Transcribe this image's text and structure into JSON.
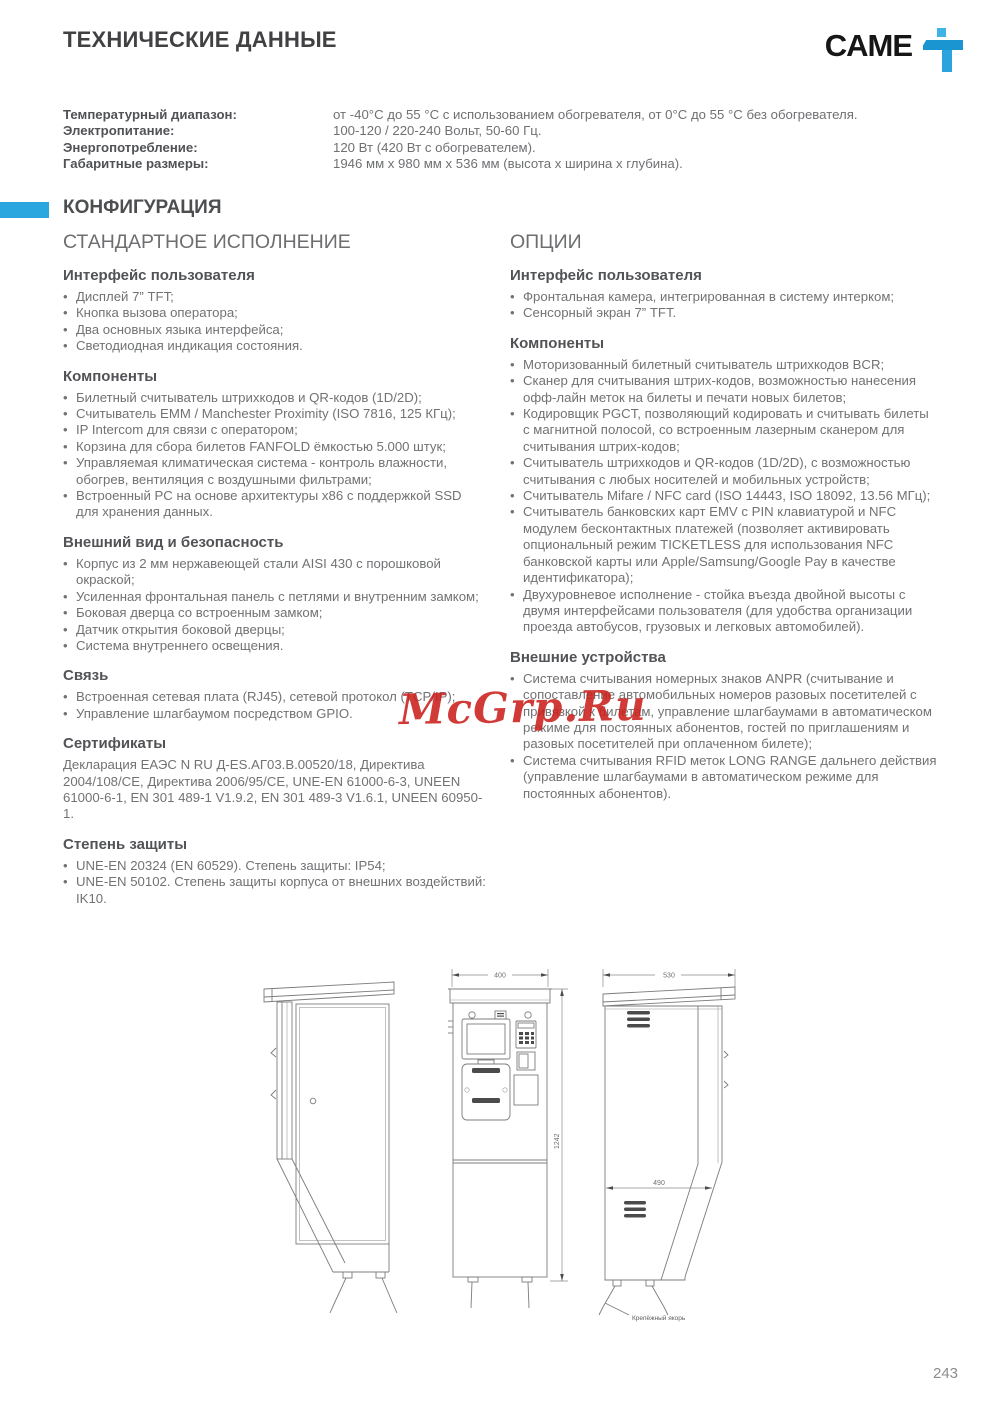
{
  "header": {
    "title": "ТЕХНИЧЕСКИЕ ДАННЫЕ",
    "brand": "CAME",
    "brand_mark_icon": "came-figure-icon"
  },
  "specs": [
    {
      "label": "Температурный диапазон:",
      "value": "от -40°C до 55 °C с использованием обогревателя, от 0°C до 55 °C без обогревателя."
    },
    {
      "label": "Электропитание:",
      "value": "100-120 / 220-240 Вольт, 50-60 Гц."
    },
    {
      "label": "Энергопотребление:",
      "value": "120 Вт (420 Вт с обогревателем)."
    },
    {
      "label": "Габаритные размеры:",
      "value": "1946 мм x 980 мм x 536 мм (высота x ширина x глубина)."
    }
  ],
  "config": {
    "section_title": "КОНФИГУРАЦИЯ",
    "left": {
      "title": "СТАНДАРТНОЕ ИСПОЛНЕНИЕ",
      "groups": [
        {
          "heading": "Интерфейс пользователя",
          "items": [
            "Дисплей 7” TFT;",
            "Кнопка вызова оператора;",
            "Два основных языка интерфейса;",
            "Светодиодная индикация состояния."
          ]
        },
        {
          "heading": "Компоненты",
          "items": [
            "Билетный считыватель штрихкодов и QR-кодов (1D/2D);",
            "Считыватель EMM / Manchester Proximity (ISO 7816, 125 КГц);",
            "IP Intercom для связи с оператором;",
            "Корзина для сбора билетов FANFOLD ёмкостью 5.000 штук;",
            "Управляемая климатическая система - контроль влажности, обогрев, вентиляция с воздушными фильтрами;",
            "Встроенный PC на основе архитектуры x86 с поддержкой SSD для хранения данных."
          ]
        },
        {
          "heading": "Внешний вид и безопасность",
          "items": [
            "Корпус из 2 мм нержавеющей стали AISI 430 с порошковой окраской;",
            "Усиленная фронтальная панель с петлями и внутренним замком;",
            "Боковая дверца со встроенным замком;",
            "Датчик открытия боковой дверцы;",
            "Система внутреннего освещения."
          ]
        },
        {
          "heading": "Связь",
          "items": [
            "Встроенная сетевая плата (RJ45), сетевой протокол (TCP/IP);",
            "Управление шлагбаумом посредством GPIO."
          ]
        },
        {
          "heading": "Сертификаты",
          "text": "Декларация ЕАЭС N RU Д-ES.АГ03.В.00520/18, Директива 2004/108/СЕ, Директива 2006/95/СЕ, UNE-EN 61000-6-3, UNEEN 61000-6-1, EN 301 489-1 V1.9.2, EN 301 489-3 V1.6.1, UNEEN 60950-1."
        },
        {
          "heading": "Степень защиты",
          "items": [
            "UNE-EN 20324 (EN 60529). Степень защиты: IP54;",
            "UNE-EN 50102. Степень защиты корпуса от внешних воздействий: IK10."
          ]
        }
      ]
    },
    "right": {
      "title": "ОПЦИИ",
      "groups": [
        {
          "heading": "Интерфейс пользователя",
          "items": [
            "Фронтальная камера, интегрированная в систему интерком;",
            "Сенсорный экран 7” TFT."
          ]
        },
        {
          "heading": "Компоненты",
          "items": [
            "Моторизованный билетный считыватель штрихкодов BCR;",
            "Сканер для считывания штрих-кодов, возможностью нанесения офф-лайн меток на билеты и печати новых билетов;",
            "Кодировщик PGCT, позволяющий кодировать и считывать билеты с магнитной полосой, со встроенным лазерным сканером для считывания штрих-кодов;",
            "Считыватель штрихкодов и QR-кодов (1D/2D), с возможностью считывания с любых носителей и мобильных устройств;",
            "Считыватель Mifare / NFC card (ISO 14443, ISO 18092, 13.56 МГц);",
            "Считыватель банковских карт EMV с PIN клавиатурой и NFC модулем бесконтактных платежей (позволяет активировать опциональный режим TICKETLESS для использования NFC банковской карты или Apple/Samsung/Google Pay в качестве идентификатора);",
            "Двухуровневое исполнение - стойка въезда двойной высоты с двумя интерфейсами пользователя (для удобства организации проезда автобусов, грузовых и легковых автомобилей)."
          ]
        },
        {
          "heading": "Внешние устройства",
          "items": [
            "Система считывания номерных знаков ANPR (считывание и сопоставление автомобильных номеров разовых посетителей с привязкой к билетам, управление шлагбаумами в автоматическом режиме для постоянных абонентов, гостей по приглашениям и разовых посетителей при оплаченном билете);",
            "Система считывания RFID меток LONG RANGE дальнего действия (управление шлагбаумами в автоматическом режиме для постоянных абонентов)."
          ]
        }
      ]
    }
  },
  "watermark": "McGrp.Ru",
  "drawings": {
    "front_width": "400",
    "front_height": "1242",
    "side_depth": "530",
    "side_base": "490",
    "anchor_label": "Крепёжный якорь"
  },
  "page": {
    "number": "243"
  },
  "colors": {
    "accent_blue": "#2aa7de",
    "watermark_red": "#c91f1b"
  }
}
